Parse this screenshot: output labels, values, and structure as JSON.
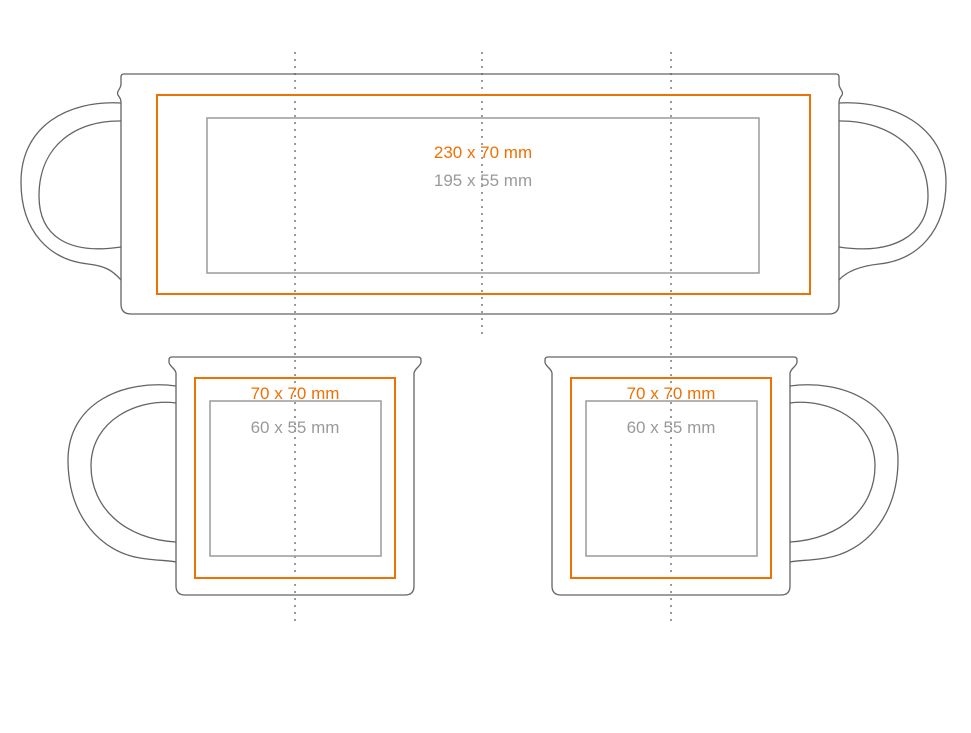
{
  "colors": {
    "print_area": "#ee7103",
    "safe_area": "#9a9a9a",
    "outline": "#646464",
    "fold_line": "#9b9b9b"
  },
  "views": {
    "wrap": {
      "print_area_label": "230 x 70 mm",
      "safe_area_label": "195 x 55 mm"
    },
    "left_mug": {
      "print_area_label": "70 x 70 mm",
      "safe_area_label": "60 x 55 mm"
    },
    "right_mug": {
      "print_area_label": "70 x 70 mm",
      "safe_area_label": "60 x 55 mm"
    }
  }
}
